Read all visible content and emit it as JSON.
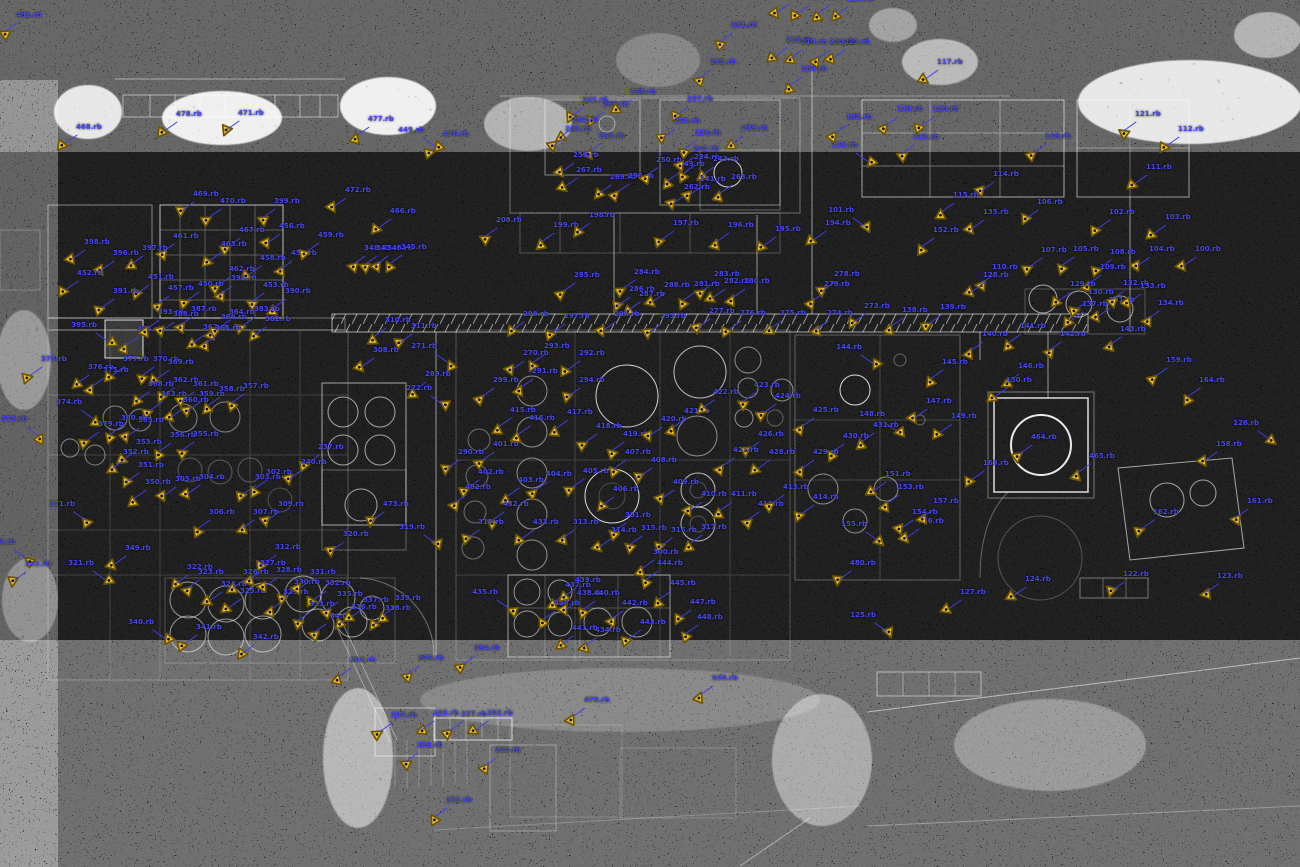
{
  "map": {
    "type": "point-cloud-plan-view",
    "colors": {
      "background": "#000000",
      "pointcloud": "#ffffff",
      "label": "#4747f5",
      "leader": "#4040e0",
      "marker_fill": "#eac42e",
      "marker_outline": "#6e5405",
      "marker_dot": "#1a1405"
    },
    "marker_glyph": "triangle-scan-position"
  },
  "markers": [
    [
      3,
      33,
      "481.rb"
    ],
    [
      63,
      145,
      "468.rb"
    ],
    [
      163,
      132,
      "478.rb"
    ],
    [
      225,
      131,
      "471.rb"
    ],
    [
      355,
      137,
      "477.rb"
    ],
    [
      430,
      152,
      "476.rb"
    ],
    [
      775,
      14,
      "228.rb"
    ],
    [
      796,
      15,
      "229.rb"
    ],
    [
      816,
      15,
      "221.rb"
    ],
    [
      834,
      17,
      "225.rb"
    ],
    [
      718,
      43,
      "231.rb"
    ],
    [
      773,
      58,
      "218.rb"
    ],
    [
      788,
      60,
      "219.rb"
    ],
    [
      816,
      60,
      "220.rb"
    ],
    [
      831,
      60,
      "223.rb"
    ],
    [
      697,
      80,
      "235.rb"
    ],
    [
      788,
      87,
      "189.rb"
    ],
    [
      924,
      80,
      "117.rb"
    ],
    [
      884,
      127,
      "119.rb"
    ],
    [
      920,
      127,
      "120.rb"
    ],
    [
      900,
      155,
      "113.rb"
    ],
    [
      870,
      163,
      "118.rb",
      1
    ],
    [
      1032,
      154,
      "116.rb"
    ],
    [
      980,
      192,
      "114.rb"
    ],
    [
      1122,
      132,
      "121.rb"
    ],
    [
      1165,
      147,
      "112.rb"
    ],
    [
      1133,
      185,
      "111.rb"
    ],
    [
      1024,
      220,
      "106.rb"
    ],
    [
      940,
      213,
      "115.rb"
    ],
    [
      970,
      230,
      "135.rb"
    ],
    [
      920,
      248,
      "152.rb"
    ],
    [
      1096,
      230,
      "102.rb"
    ],
    [
      1152,
      235,
      "103.rb"
    ],
    [
      1182,
      267,
      "100.rb"
    ],
    [
      1136,
      267,
      "104.rb"
    ],
    [
      1060,
      267,
      "105.rb"
    ],
    [
      1028,
      268,
      "107.rb"
    ],
    [
      1097,
      270,
      "108.rb"
    ],
    [
      1087,
      285,
      "109.rb"
    ],
    [
      979,
      285,
      "110.rb"
    ],
    [
      867,
      228,
      "101.rb",
      1
    ],
    [
      569,
      118,
      "265.rb"
    ],
    [
      590,
      122,
      "266.rb"
    ],
    [
      617,
      110,
      "258.rb"
    ],
    [
      674,
      117,
      "257.rb"
    ],
    [
      661,
      139,
      "254.rb"
    ],
    [
      682,
      151,
      "236.rb"
    ],
    [
      729,
      146,
      "239.rb"
    ],
    [
      559,
      138,
      "264.rb"
    ],
    [
      552,
      147,
      "253.rb"
    ],
    [
      586,
      154,
      "252.rb"
    ],
    [
      560,
      173,
      "259.rb"
    ],
    [
      563,
      188,
      "267.rb"
    ],
    [
      597,
      195,
      "269.rb"
    ],
    [
      615,
      194,
      "256.rb"
    ],
    [
      643,
      178,
      "250.rb"
    ],
    [
      666,
      182,
      "249.rb"
    ],
    [
      680,
      167,
      "242.rb"
    ],
    [
      681,
      175,
      "234.rb"
    ],
    [
      700,
      177,
      "243.rb"
    ],
    [
      718,
      195,
      "263.rb"
    ],
    [
      671,
      205,
      "262.rb"
    ],
    [
      687,
      197,
      "241.rb"
    ],
    [
      833,
      135,
      "188.rb"
    ],
    [
      437,
      148,
      "449.rb",
      1
    ],
    [
      483,
      238,
      "208.rb"
    ],
    [
      540,
      243,
      "199.rb"
    ],
    [
      576,
      233,
      "198.rb"
    ],
    [
      660,
      241,
      "197.rb"
    ],
    [
      715,
      243,
      "196.rb"
    ],
    [
      762,
      247,
      "195.rb"
    ],
    [
      812,
      241,
      "194.rb"
    ],
    [
      71,
      260,
      "398.rb"
    ],
    [
      100,
      271,
      "396.rb"
    ],
    [
      129,
      266,
      "397.rb"
    ],
    [
      160,
      254,
      "461.rb"
    ],
    [
      180,
      212,
      "469.rb"
    ],
    [
      207,
      219,
      "470.rb"
    ],
    [
      226,
      248,
      "467.rb"
    ],
    [
      261,
      219,
      "399.rb"
    ],
    [
      266,
      244,
      "456.rb"
    ],
    [
      278,
      271,
      "455.rb"
    ],
    [
      216,
      287,
      "462.rb"
    ],
    [
      247,
      276,
      "458.rb"
    ],
    [
      208,
      262,
      "463.rb"
    ],
    [
      377,
      229,
      "466.rb"
    ],
    [
      351,
      266,
      "348.rb"
    ],
    [
      363,
      266,
      "347.rb"
    ],
    [
      374,
      266,
      "346.rb"
    ],
    [
      388,
      265,
      "345.rb"
    ],
    [
      305,
      253,
      "459.rb"
    ],
    [
      332,
      208,
      "472.rb"
    ],
    [
      64,
      291,
      "452.rb"
    ],
    [
      135,
      295,
      "451.rb"
    ],
    [
      100,
      309,
      "391.rb"
    ],
    [
      155,
      306,
      "457.rb"
    ],
    [
      185,
      302,
      "450.rb"
    ],
    [
      218,
      296,
      "392.rb"
    ],
    [
      250,
      303,
      "453.rb"
    ],
    [
      272,
      309,
      "390.rb"
    ],
    [
      110,
      343,
      "395.rb",
      1
    ],
    [
      124,
      347,
      "394.rb"
    ],
    [
      145,
      330,
      "393.rb"
    ],
    [
      160,
      332,
      "388.rb"
    ],
    [
      178,
      327,
      "387.rb"
    ],
    [
      190,
      345,
      "367.rb"
    ],
    [
      208,
      335,
      "366.rb"
    ],
    [
      216,
      330,
      "364.rb"
    ],
    [
      241,
      327,
      "383.rb"
    ],
    [
      252,
      337,
      "382.rb"
    ],
    [
      202,
      346,
      "365.rb"
    ],
    [
      28,
      377,
      "373.rb"
    ],
    [
      75,
      385,
      "376.rb"
    ],
    [
      90,
      388,
      "375.rb"
    ],
    [
      110,
      377,
      "377.rb"
    ],
    [
      140,
      377,
      "370.rb"
    ],
    [
      155,
      380,
      "369.rb"
    ],
    [
      135,
      402,
      "368.rb"
    ],
    [
      160,
      398,
      "362.rb"
    ],
    [
      180,
      402,
      "361.rb"
    ],
    [
      148,
      412,
      "363.rb"
    ],
    [
      170,
      418,
      "360.rb"
    ],
    [
      186,
      412,
      "359.rb"
    ],
    [
      206,
      407,
      "358.rb"
    ],
    [
      230,
      404,
      "357.rb"
    ],
    [
      95,
      420,
      "374.rb",
      1
    ],
    [
      40,
      437,
      "372.rb",
      1
    ],
    [
      85,
      442,
      "379.rb"
    ],
    [
      108,
      436,
      "380.rb"
    ],
    [
      125,
      438,
      "385.rb"
    ],
    [
      157,
      453,
      "356.rb"
    ],
    [
      180,
      452,
      "355.rb"
    ],
    [
      123,
      460,
      "353.rb"
    ],
    [
      110,
      470,
      "352.rb"
    ],
    [
      125,
      483,
      "351.rb"
    ],
    [
      88,
      522,
      "371.rb",
      1
    ],
    [
      132,
      500,
      "350.rb"
    ],
    [
      162,
      497,
      "305.rb"
    ],
    [
      186,
      495,
      "304.rb"
    ],
    [
      242,
      495,
      "303.rb"
    ],
    [
      253,
      490,
      "302.rb"
    ],
    [
      196,
      530,
      "306.rb"
    ],
    [
      240,
      530,
      "307.rb"
    ],
    [
      265,
      522,
      "309.rb"
    ],
    [
      262,
      565,
      "312.rb"
    ],
    [
      112,
      566,
      "349.rb"
    ],
    [
      28,
      560,
      "344.rb",
      1
    ],
    [
      12,
      582,
      "343.rb"
    ],
    [
      305,
      465,
      "237.rb"
    ],
    [
      288,
      480,
      "240.rb"
    ],
    [
      330,
      552,
      "320.rb"
    ],
    [
      370,
      522,
      "473.rb"
    ],
    [
      372,
      338,
      "310.rb"
    ],
    [
      398,
      344,
      "311.rb"
    ],
    [
      360,
      368,
      "308.rb"
    ],
    [
      412,
      392,
      "289.rb"
    ],
    [
      445,
      470,
      "290.rb"
    ],
    [
      621,
      290,
      "284.rb"
    ],
    [
      561,
      293,
      "285.rb"
    ],
    [
      701,
      292,
      "283.rb"
    ],
    [
      711,
      299,
      "282.rb"
    ],
    [
      616,
      307,
      "286.rb"
    ],
    [
      626,
      312,
      "287.rb"
    ],
    [
      651,
      303,
      "288.rb"
    ],
    [
      681,
      302,
      "281.rb"
    ],
    [
      731,
      299,
      "280.rb"
    ],
    [
      811,
      302,
      "279.rb"
    ],
    [
      821,
      292,
      "278.rb"
    ],
    [
      510,
      332,
      "298.rb"
    ],
    [
      551,
      334,
      "297.rb"
    ],
    [
      601,
      332,
      "296.rb"
    ],
    [
      647,
      334,
      "295.rb"
    ],
    [
      696,
      329,
      "277.rb"
    ],
    [
      727,
      331,
      "276.rb"
    ],
    [
      767,
      331,
      "275.rb"
    ],
    [
      814,
      331,
      "274.rb"
    ],
    [
      851,
      324,
      "273.rb"
    ],
    [
      450,
      364,
      "271.rb",
      1
    ],
    [
      510,
      371,
      "270.rb"
    ],
    [
      531,
      364,
      "293.rb"
    ],
    [
      566,
      371,
      "292.rb"
    ],
    [
      519,
      389,
      "291.rb"
    ],
    [
      566,
      398,
      "294.rb"
    ],
    [
      480,
      398,
      "299.rb"
    ],
    [
      445,
      406,
      "272.rb",
      1
    ],
    [
      480,
      462,
      "401.rb"
    ],
    [
      465,
      490,
      "402.rb"
    ],
    [
      505,
      498,
      "403.rb"
    ],
    [
      533,
      492,
      "404.rb"
    ],
    [
      570,
      489,
      "405.rb"
    ],
    [
      600,
      507,
      "406.rb"
    ],
    [
      612,
      470,
      "407.rb"
    ],
    [
      638,
      478,
      "408.rb"
    ],
    [
      660,
      500,
      "409.rb"
    ],
    [
      688,
      512,
      "410.rb"
    ],
    [
      718,
      512,
      "411.rb"
    ],
    [
      745,
      522,
      "412.rb"
    ],
    [
      770,
      505,
      "413.rb"
    ],
    [
      800,
      515,
      "414.rb"
    ],
    [
      497,
      428,
      "415.rb"
    ],
    [
      516,
      436,
      "416.rb"
    ],
    [
      554,
      430,
      "417.rb"
    ],
    [
      583,
      444,
      "418.rb"
    ],
    [
      610,
      452,
      "419.rb"
    ],
    [
      648,
      437,
      "420.rb"
    ],
    [
      671,
      429,
      "421.rb"
    ],
    [
      700,
      410,
      "422.rb"
    ],
    [
      741,
      403,
      "423.rb"
    ],
    [
      762,
      414,
      "424.rb"
    ],
    [
      800,
      428,
      "425.rb"
    ],
    [
      745,
      452,
      "426.rb"
    ],
    [
      720,
      468,
      "427.rb"
    ],
    [
      756,
      470,
      "428.rb"
    ],
    [
      800,
      470,
      "429.rb"
    ],
    [
      830,
      454,
      "430.rb"
    ],
    [
      860,
      443,
      "431.rb"
    ],
    [
      490,
      522,
      "432.rb"
    ],
    [
      520,
      540,
      "433.rb"
    ],
    [
      560,
      540,
      "313.rb"
    ],
    [
      598,
      548,
      "314.rb"
    ],
    [
      628,
      546,
      "315.rb"
    ],
    [
      658,
      548,
      "316.rb"
    ],
    [
      688,
      545,
      "317.rb"
    ],
    [
      465,
      540,
      "318.rb"
    ],
    [
      438,
      545,
      "319.rb",
      1
    ],
    [
      612,
      533,
      "301.rb"
    ],
    [
      640,
      570,
      "300.rb"
    ],
    [
      452,
      505,
      "482.rb"
    ],
    [
      970,
      293,
      "128.rb"
    ],
    [
      1057,
      302,
      "129.rb"
    ],
    [
      1075,
      310,
      "130.rb"
    ],
    [
      1096,
      318,
      "131.rb"
    ],
    [
      1110,
      301,
      "132.rb"
    ],
    [
      1127,
      304,
      "133.rb"
    ],
    [
      1145,
      321,
      "134.rb"
    ],
    [
      1069,
      322,
      "137.rb"
    ],
    [
      889,
      328,
      "138.rb"
    ],
    [
      927,
      325,
      "139.rb"
    ],
    [
      969,
      352,
      "140.rb"
    ],
    [
      1007,
      344,
      "141.rb"
    ],
    [
      1047,
      352,
      "142.rb"
    ],
    [
      1107,
      347,
      "143.rb"
    ],
    [
      875,
      365,
      "144.rb",
      1
    ],
    [
      929,
      380,
      "145.rb"
    ],
    [
      1005,
      384,
      "146.rb"
    ],
    [
      913,
      419,
      "147.rb"
    ],
    [
      898,
      432,
      "148.rb",
      1
    ],
    [
      938,
      434,
      "149.rb"
    ],
    [
      993,
      398,
      "150.rb"
    ],
    [
      1018,
      455,
      "464.rb"
    ],
    [
      1076,
      474,
      "465.rb"
    ],
    [
      1272,
      441,
      "126.rb",
      1
    ],
    [
      872,
      492,
      "151.rb"
    ],
    [
      885,
      505,
      "153.rb"
    ],
    [
      899,
      530,
      "154.rb"
    ],
    [
      880,
      542,
      "155.rb",
      1
    ],
    [
      905,
      539,
      "156.rb"
    ],
    [
      920,
      519,
      "157.rb"
    ],
    [
      1203,
      462,
      "158.rb"
    ],
    [
      1234,
      519,
      "161.rb"
    ],
    [
      1140,
      530,
      "162.rb"
    ],
    [
      970,
      481,
      "163.rb"
    ],
    [
      1153,
      378,
      "159.rb"
    ],
    [
      1186,
      398,
      "164.rb"
    ],
    [
      107,
      581,
      "321.rb",
      1
    ],
    [
      174,
      585,
      "322.rb"
    ],
    [
      185,
      590,
      "323.rb"
    ],
    [
      208,
      602,
      "324.rb"
    ],
    [
      227,
      609,
      "325.rb"
    ],
    [
      230,
      590,
      "326.rb"
    ],
    [
      247,
      581,
      "327.rb"
    ],
    [
      263,
      588,
      "328.rb"
    ],
    [
      270,
      610,
      "329.rb"
    ],
    [
      281,
      600,
      "330.rb"
    ],
    [
      297,
      590,
      "331.rb"
    ],
    [
      312,
      601,
      "332.rb"
    ],
    [
      296,
      622,
      "333.rb"
    ],
    [
      312,
      634,
      "334.rb"
    ],
    [
      324,
      612,
      "335.rb"
    ],
    [
      338,
      625,
      "336.rb"
    ],
    [
      350,
      618,
      "337.rb"
    ],
    [
      372,
      626,
      "338.rb"
    ],
    [
      382,
      616,
      "339.rb"
    ],
    [
      167,
      640,
      "340.rb",
      1
    ],
    [
      183,
      645,
      "341.rb"
    ],
    [
      240,
      655,
      "342.rb"
    ],
    [
      511,
      610,
      "435.rb",
      1
    ],
    [
      541,
      621,
      "436.rb"
    ],
    [
      552,
      603,
      "437.rb"
    ],
    [
      564,
      611,
      "438.rb"
    ],
    [
      562,
      598,
      "439.rb"
    ],
    [
      581,
      611,
      "440.rb"
    ],
    [
      582,
      648,
      "434.rb"
    ],
    [
      559,
      646,
      "441.rb"
    ],
    [
      609,
      621,
      "442.rb"
    ],
    [
      627,
      640,
      "443.rb"
    ],
    [
      644,
      581,
      "444.rb"
    ],
    [
      657,
      601,
      "445.rb"
    ],
    [
      677,
      620,
      "447.rb"
    ],
    [
      684,
      635,
      "448.rb"
    ],
    [
      699,
      696,
      "446.rb"
    ],
    [
      571,
      718,
      "479.rb"
    ],
    [
      837,
      581,
      "480.rb"
    ],
    [
      461,
      666,
      "384.rb"
    ],
    [
      337,
      678,
      "203.rb"
    ],
    [
      405,
      676,
      "205.rb"
    ],
    [
      378,
      733,
      "224.rb"
    ],
    [
      420,
      731,
      "230.rb"
    ],
    [
      448,
      732,
      "227.rb"
    ],
    [
      474,
      731,
      "202.rb"
    ],
    [
      404,
      763,
      "226.rb"
    ],
    [
      482,
      768,
      "222.rb"
    ],
    [
      433,
      818,
      "211.rb"
    ],
    [
      947,
      610,
      "127.rb"
    ],
    [
      889,
      633,
      "125.rb",
      1
    ],
    [
      1012,
      597,
      "124.rb"
    ],
    [
      1110,
      592,
      "122.rb"
    ],
    [
      1204,
      594,
      "123.rb"
    ]
  ]
}
